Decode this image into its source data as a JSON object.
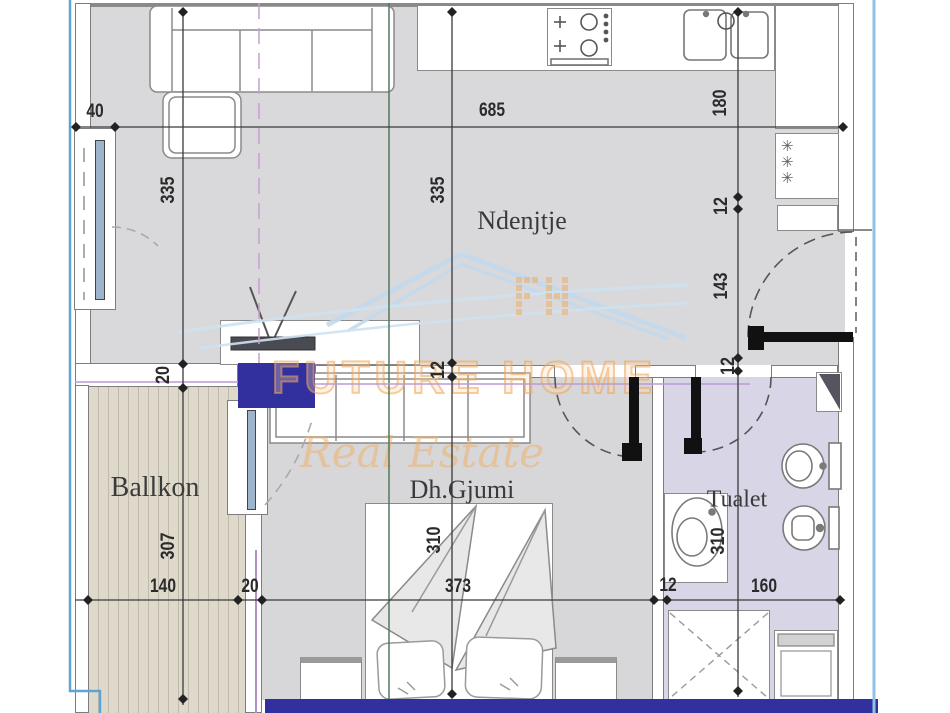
{
  "plan": {
    "type": "apartment-floor-plan",
    "watermark": {
      "line1": "FUTURE HOME",
      "line2": "Real Estate",
      "monogram": "FH"
    }
  },
  "rooms": {
    "living": "Ndenjtje",
    "balcony": "Ballkon",
    "bedroom": "Dh.Gjumi",
    "bathroom": "Tualet"
  },
  "dims": {
    "top": {
      "w40": "40",
      "w685": "685"
    },
    "left": {
      "h335": "335",
      "h20": "20",
      "h307": "307"
    },
    "center": {
      "h335": "335",
      "h12": "12",
      "h310": "310"
    },
    "right": {
      "h180": "180",
      "h12a": "12",
      "h143": "143",
      "h12b": "12",
      "h310": "310"
    },
    "bottom": {
      "w140": "140",
      "w20": "20",
      "w373": "373",
      "w12": "12",
      "w160": "160"
    }
  },
  "fixtures": {
    "closet_stars": "✳✳✳"
  },
  "colors": {
    "floor_gray": "#d9d9db",
    "balcony_floor": "#ded9cb",
    "bathroom_floor": "#d8d5e6",
    "structural_blue": "#32309f",
    "frame_blue": "#5da3d6",
    "watermark_orange": "#efac63",
    "watermark_blue": "#c3daed",
    "section_green": "#53795e",
    "axis_magenta": "#bb9cd4"
  }
}
